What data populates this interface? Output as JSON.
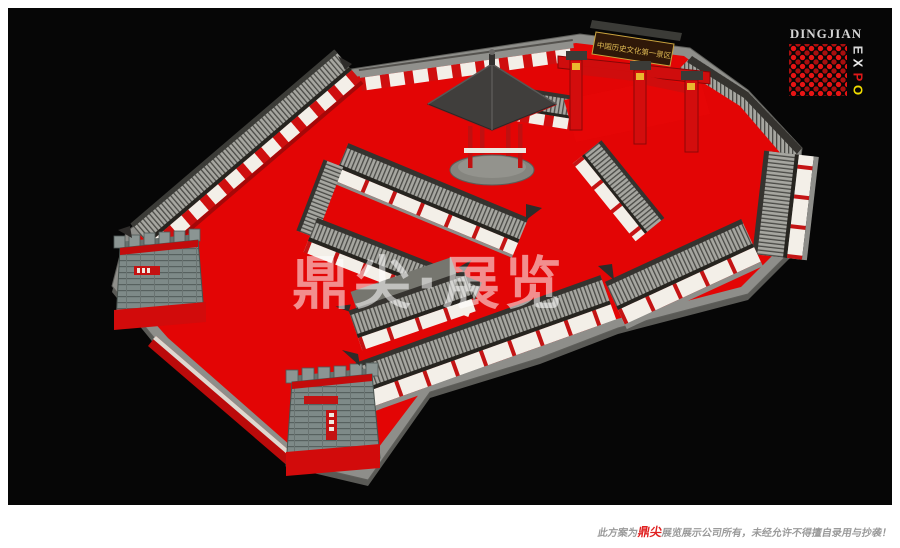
{
  "logo": {
    "brand": "DINGJIAN",
    "expo": [
      "E",
      "X",
      "P",
      "O"
    ],
    "expo_colors": [
      "#d8d8d8",
      "#ececec",
      "#e01818",
      "#f0dc00"
    ],
    "dot_color": "#e81414"
  },
  "watermark": {
    "text": "鼎尖·展览"
  },
  "footer": {
    "prefix": "此方案为",
    "brand": "鼎尖",
    "suffix": "展览展示公司所有，未经允许不得擅自录用与抄袭！",
    "brand_color": "#e02020",
    "text_color": "#9a9a9a"
  },
  "scene": {
    "gate_plaque_text": "中国历史文化第一景区",
    "colors": {
      "stage_bg": "#060606",
      "carpet": "#e30505",
      "roof_tile": "#a6a6a0",
      "roof_ridge": "#35332f",
      "wall": "#f3efe8",
      "column_red": "#c41414",
      "platform": "#8e8e8a",
      "tower_stone": "#7e8a88",
      "gate_red": "#d30d0d",
      "plaque_gold": "#e2bd55"
    }
  }
}
